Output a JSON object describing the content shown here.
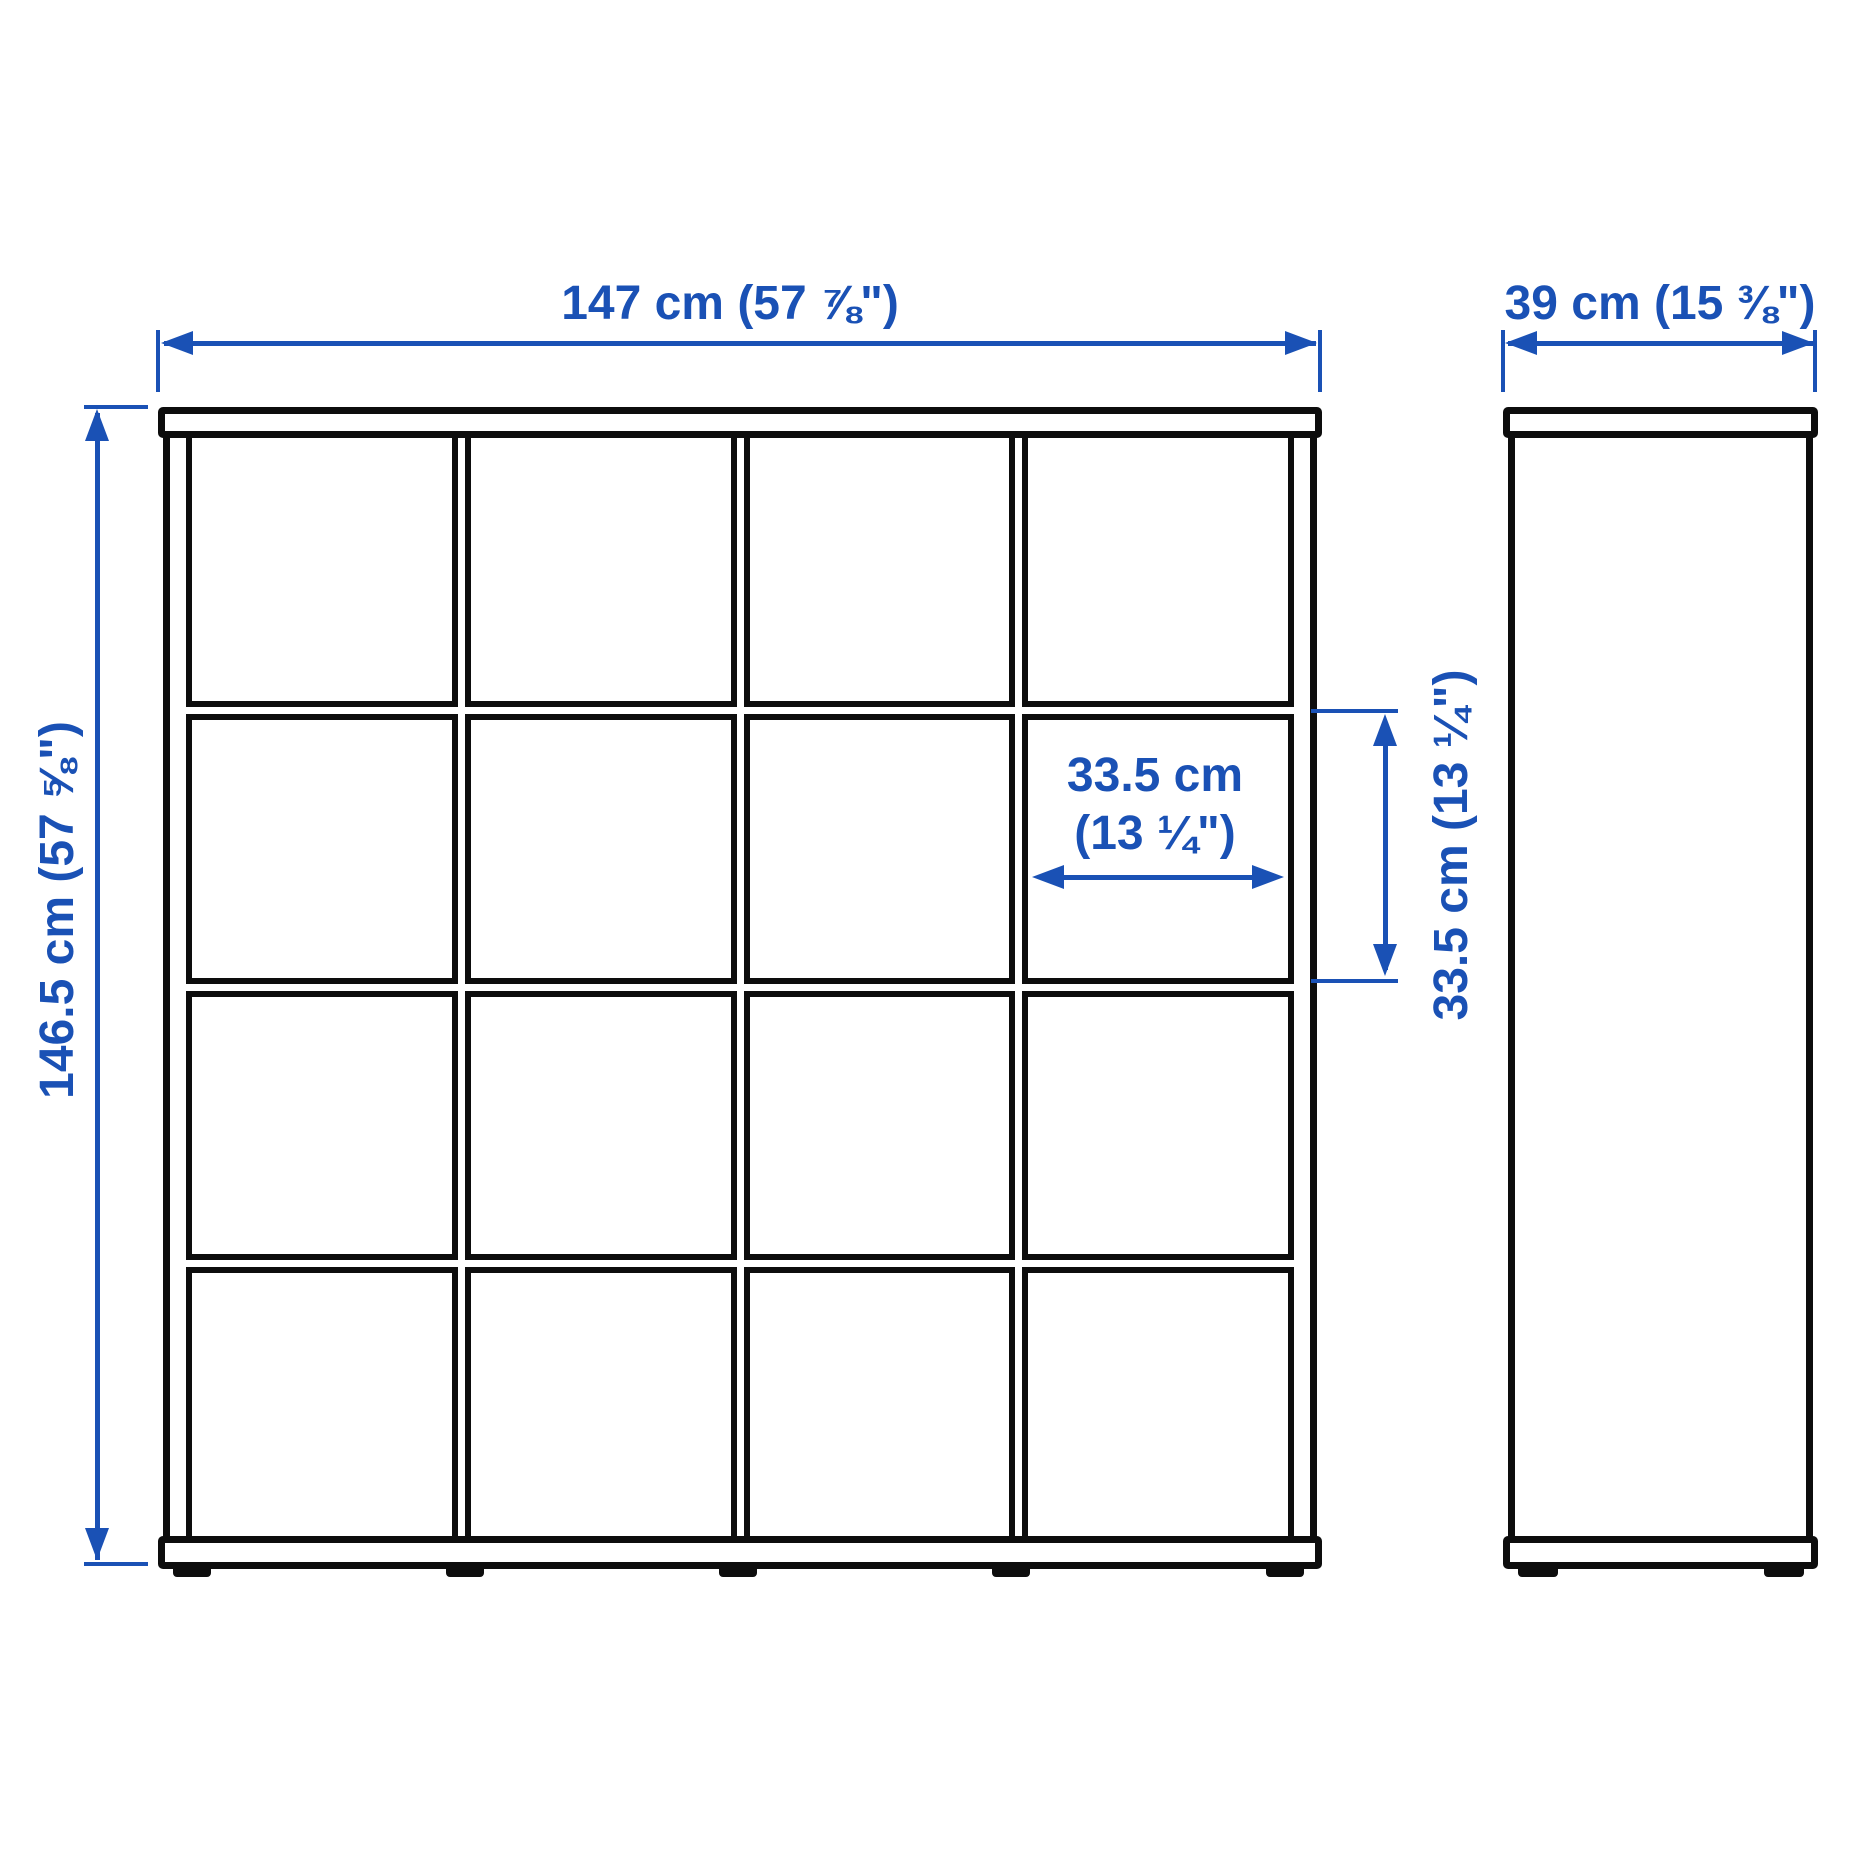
{
  "colors": {
    "dimension": "#1a51b5",
    "outline": "#0d0d0d",
    "background": "#ffffff"
  },
  "front_view": {
    "grid_rows": 4,
    "grid_cols": 4,
    "feet": 5
  },
  "side_view": {
    "feet": 2
  },
  "dimensions": {
    "width": {
      "label": "147 cm (57 ⅞\")"
    },
    "depth": {
      "label": "39 cm (15 ⅜\")"
    },
    "height": {
      "label": "146.5 cm (57 ⅝\")"
    },
    "cube_width": {
      "label_line1": "33.5 cm",
      "label_line2": "(13 ¼\")"
    },
    "cube_height": {
      "label": "33.5 cm (13 ¼\")"
    }
  }
}
